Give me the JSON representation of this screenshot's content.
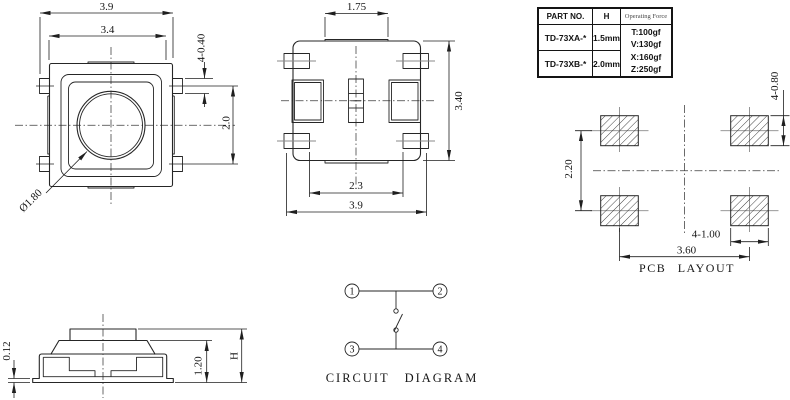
{
  "colors": {
    "ink": "#262626",
    "background": "#ffffff",
    "faint_line": "#8a8a8a"
  },
  "spec_table": {
    "header": {
      "part_no": "PART NO.",
      "h": "H",
      "operating_force": "Operating Force"
    },
    "rows": [
      {
        "part_no": "TD-73XA-*",
        "h": "1.5mm"
      },
      {
        "part_no": "TD-73XB-*",
        "h": "2.0mm"
      }
    ],
    "operating_force_values": [
      "T:100gf",
      "V:130gf",
      "X:160gf",
      "Z:250gf"
    ]
  },
  "top_view": {
    "dim_outer_width": "3.9",
    "dim_inner_width": "3.4",
    "dim_terminal_height": "4-0.40",
    "dim_terminal_pitch": "2.0",
    "dim_button_diameter": "Ø1.80"
  },
  "bottom_view": {
    "dim_top_width": "1.75",
    "dim_height": "3.40",
    "dim_inner_width": "2.3",
    "dim_outer_width": "3.9"
  },
  "pcb_layout": {
    "title": "PCB LAYOUT",
    "dim_pad_height": "4-0.80",
    "dim_row_pitch": "2.20",
    "dim_pad_width": "4-1.00",
    "dim_col_pitch": "3.60"
  },
  "side_view": {
    "dim_foot_height": "0.12",
    "dim_body_height": "1.20",
    "dim_total_height": "H"
  },
  "circuit_diagram": {
    "title": "CIRCUIT DIAGRAM",
    "terminals": [
      "1",
      "2",
      "3",
      "4"
    ]
  }
}
